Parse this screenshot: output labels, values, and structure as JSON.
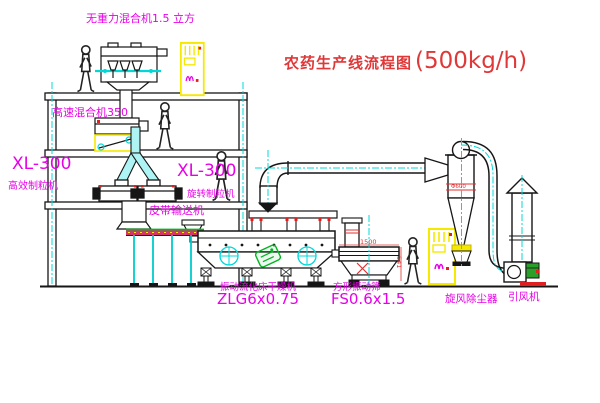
{
  "title": {
    "text": "农药生产线流程图",
    "capacity": "(500kg/h)"
  },
  "labels": {
    "gravity_mixer": "无重力混合机1.5 立方",
    "high_speed_mixer": "高速混合机350",
    "granulator_left": {
      "model": "XL-300",
      "name": "高效制粒机"
    },
    "granulator_right": {
      "model": "XL-300",
      "name": "旋转制粒机"
    },
    "belt_conveyor": "皮带输送机",
    "dryer": {
      "name": "振动流化床干燥机",
      "model": "ZLG6x0.75"
    },
    "sieve": {
      "name": "方形振动筛",
      "model": "FS0.6x1.5"
    },
    "cyclone": "旋风除尘器",
    "fan": "引风机"
  },
  "dimensions": {
    "sieve_length": "1500",
    "sieve_height": "541",
    "cyclone_diameter": "Φ600"
  },
  "colors": {
    "label_magenta": "#e800e8",
    "title_red": "#e03838",
    "pipe_cyan": "#00d8d8",
    "cabinet_yellow": "#f5e900",
    "watermark_green": "#00b520",
    "line_black": "#161616"
  }
}
